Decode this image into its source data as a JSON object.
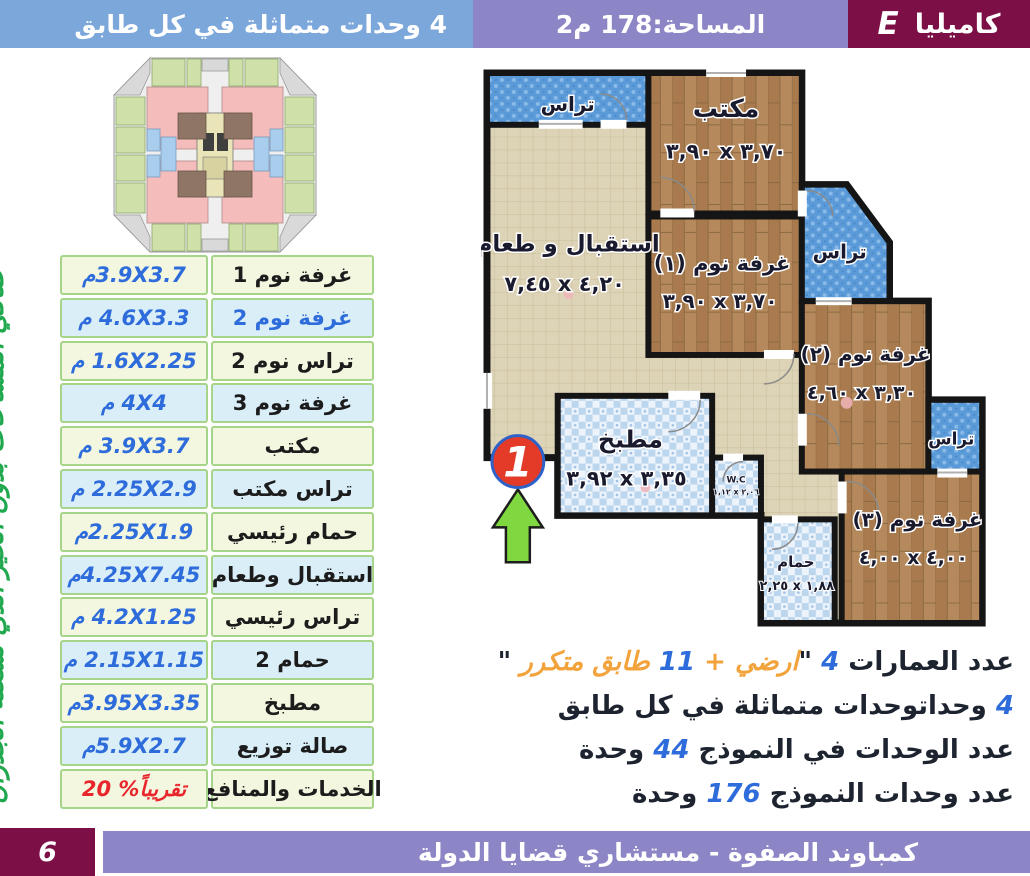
{
  "header": {
    "model_letter": "E",
    "model_name": "كاميليا",
    "area": "المساحة:178 م2",
    "units_note": "4 وحدات متماثلة في كل طابق"
  },
  "side_note": "صافي المساحات بدون الحيز الذي تشغلة الجدران",
  "areas_table": {
    "rows": [
      {
        "label": "غرفة نوم 1",
        "value": "3.9X3.7م"
      },
      {
        "label": "غرفة نوم 2",
        "value": "4.6X3.3 م",
        "label_color": "blue"
      },
      {
        "label": "تراس نوم 2",
        "value": "1.6X2.25 م"
      },
      {
        "label": "غرفة نوم 3",
        "value": "4X4 م"
      },
      {
        "label": "مكتب",
        "value": "3.9X3.7 م"
      },
      {
        "label": "تراس مكتب",
        "value": "2.25X2.9 م"
      },
      {
        "label": "حمام رئيسي",
        "value": "2.25X1.9م"
      },
      {
        "label": "استقبال وطعام",
        "value": "4.25X7.45م"
      },
      {
        "label": "تراس رئيسي",
        "value": "4.2X1.25 م"
      },
      {
        "label": "حمام 2",
        "value": "2.15X1.15 م"
      },
      {
        "label": "مطبخ",
        "value": "3.95X3.35م"
      },
      {
        "label": "صالة توزيع",
        "value": "5.9X2.7م"
      },
      {
        "label": "الخدمات والمنافع",
        "value": "20 %تقريباً",
        "value_color": "red",
        "value_dir": "ltr"
      }
    ]
  },
  "floorplan": {
    "terrace": "تراس",
    "office": {
      "name": "مكتب",
      "dims": "٣,٩٠ x ٣,٧٠"
    },
    "reception": {
      "name": "استقبال و طعام",
      "dims": "٧,٤٥ x ٤,٢٠"
    },
    "bedroom1": {
      "name": "غرفة نوم (١)",
      "dims": "٣,٩٠ x ٣,٧٠"
    },
    "bedroom2": {
      "name": "غرفة نوم (٢)",
      "dims": "٤,٦٠ x ٣,٣٠"
    },
    "bedroom3": {
      "name": "غرفة نوم (٣)",
      "dims": "٤,٠٠ x ٤,٠٠"
    },
    "kitchen": {
      "name": "مطبخ",
      "dims": "٣,٩٢ x ٣,٣٥"
    },
    "wc": {
      "name": "W.C",
      "dims": "١,١٢ x ٢,٠٦"
    },
    "bathroom": {
      "name": "حمام",
      "dims": "٢,٢٥ x ١,٨٨"
    },
    "entrance_number": "1"
  },
  "info_lines": [
    {
      "segments": [
        {
          "text": "عدد العمارات ",
          "color": "dark"
        },
        {
          "text": "4",
          "color": "blue"
        },
        {
          "text": " \"",
          "color": "dark"
        },
        {
          "text": "ارضي + ",
          "color": "orange"
        },
        {
          "text": "11",
          "color": "blue"
        },
        {
          "text": " طابق متكرر",
          "color": "orange"
        },
        {
          "text": " \"",
          "color": "dark"
        }
      ]
    },
    {
      "segments": [
        {
          "text": "4",
          "color": "blue"
        },
        {
          "text": " وحداتوحدات متماثلة في كل طابق",
          "color": "dark"
        }
      ]
    },
    {
      "segments": [
        {
          "text": "عدد الوحدات في النموذج ",
          "color": "dark"
        },
        {
          "text": "44",
          "color": "blue"
        },
        {
          "text": " وحدة",
          "color": "dark"
        }
      ]
    },
    {
      "segments": [
        {
          "text": "عدد وحدات  النموذج ",
          "color": "dark"
        },
        {
          "text": "176",
          "color": "blue"
        },
        {
          "text": " وحدة",
          "color": "dark"
        }
      ]
    }
  ],
  "footer": {
    "page_number": "6",
    "title": "كمباوند الصفوة - مستشاري قضايا الدولة"
  },
  "colors": {
    "maroon": "#7c0f45",
    "header_blue": "#7ba7db",
    "lavender": "#8d86c6",
    "accent_blue": "#2e6cdb",
    "accent_orange": "#f2a33c",
    "accent_red": "#e8262b",
    "green": "#1fa84d",
    "terrace_blue": "#5b9ad8",
    "wood_brown": "#b5895c",
    "tile_beige": "#ddd3b6"
  }
}
